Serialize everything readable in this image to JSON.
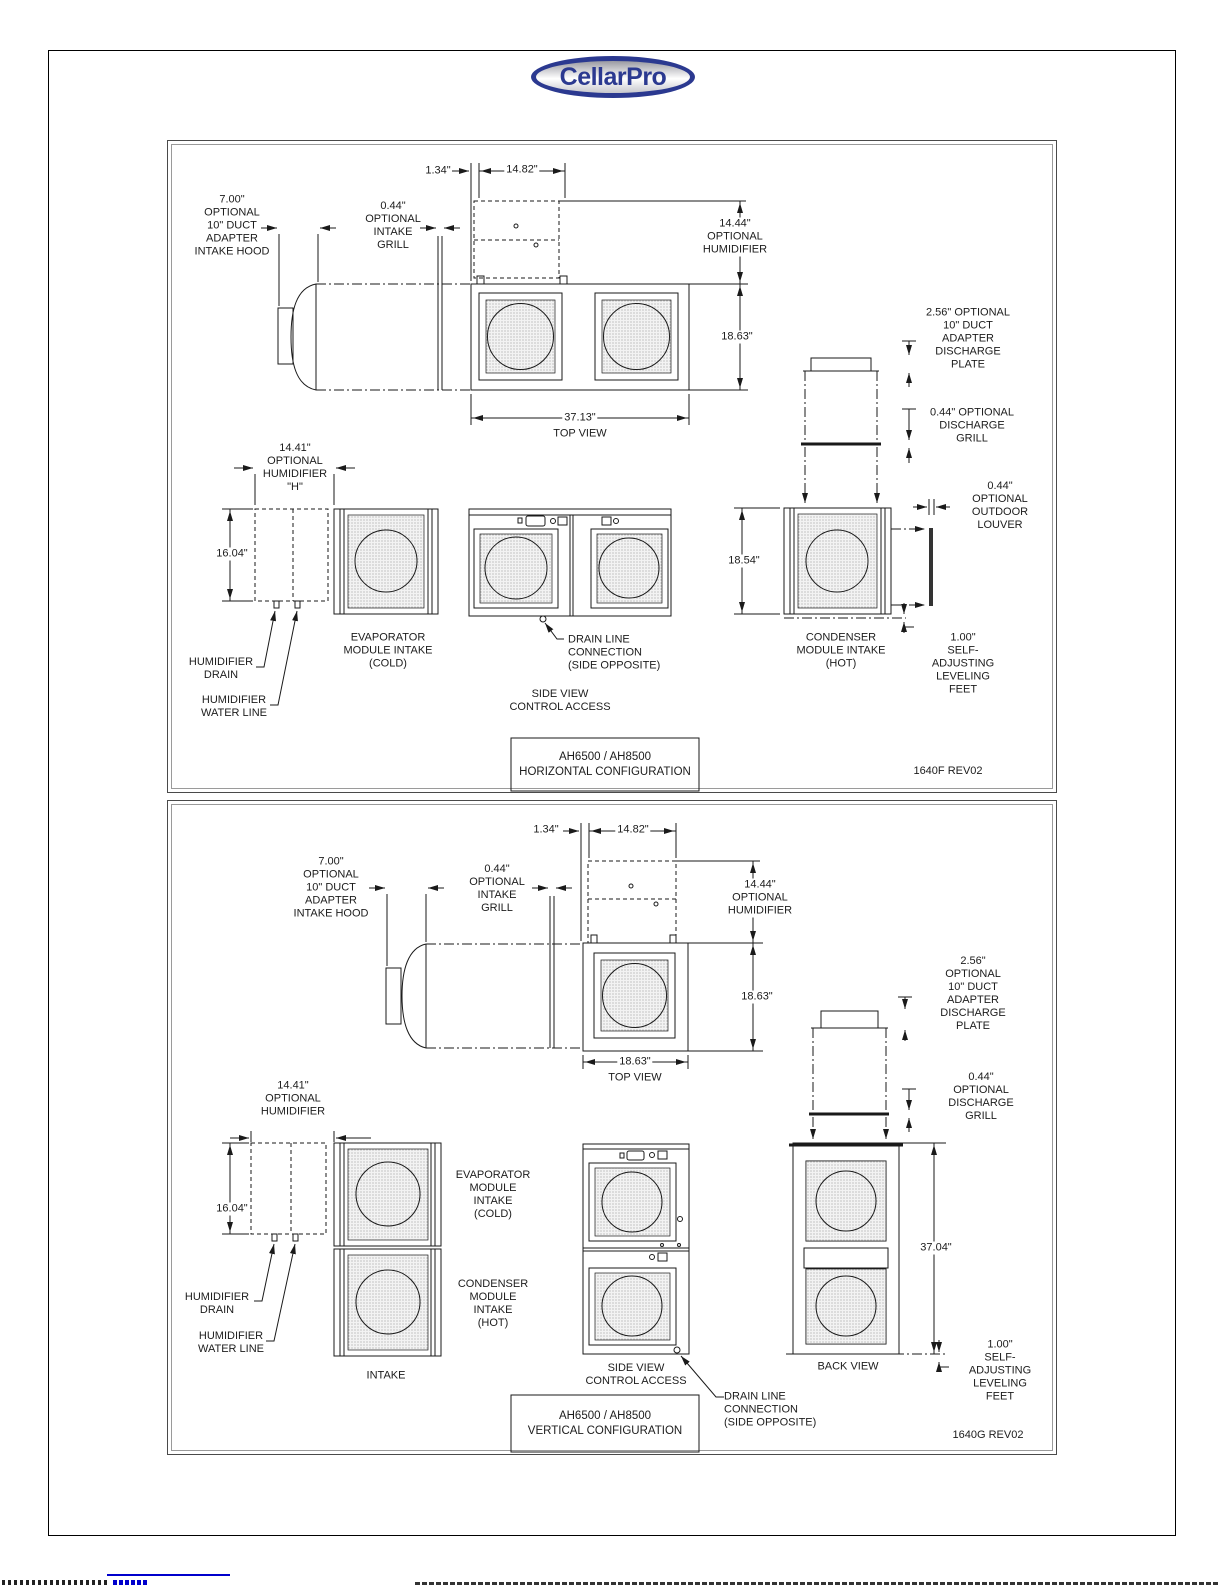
{
  "logo": {
    "text": "CellarPro",
    "ring_color": "#2b3990",
    "text_color": "#2b3990"
  },
  "horizontal": {
    "labels": {
      "dim_gap": "1.34\"",
      "dim_humidifier_width": "14.82\"",
      "intake_hood": "7.00\"\nOPTIONAL\n10\" DUCT\nADAPTER\nINTAKE HOOD",
      "intake_grill": "0.44\"\nOPTIONAL\nINTAKE\nGRILL",
      "humidifier_top": "14.44\"\nOPTIONAL\nHUMIDIFIER",
      "unit_depth": "18.63\"",
      "discharge_plate": "2.56\" OPTIONAL\n10\" DUCT\nADAPTER\nDISCHARGE\nPLATE",
      "unit_width": "37.13\"",
      "top_view": "TOP VIEW",
      "discharge_grill": "0.44\" OPTIONAL\nDISCHARGE\nGRILL",
      "humidifier_side": "14.41\"\nOPTIONAL\nHUMIDIFIER\n\"H\"",
      "humidifier_height": "16.04\"",
      "outdoor_louver": "0.44\" OPTIONAL\nOUTDOOR\nLOUVER",
      "condenser_height": "18.54\"",
      "evaporator_intake": "EVAPORATOR\nMODULE INTAKE\n(COLD)",
      "drain_line": "DRAIN LINE\nCONNECTION\n(SIDE OPPOSITE)",
      "condenser_intake": "CONDENSER\nMODULE INTAKE\n(HOT)",
      "leveling_feet": "1.00\"\nSELF-ADJUSTING\nLEVELING\nFEET",
      "humidifier_drain": "HUMIDIFIER\nDRAIN",
      "humidifier_water": "HUMIDIFIER\nWATER LINE",
      "side_view": "SIDE VIEW\nCONTROL ACCESS"
    },
    "title": "AH6500 / AH8500\nHORIZONTAL CONFIGURATION",
    "doc_number": "1640F REV02"
  },
  "vertical": {
    "labels": {
      "dim_gap": "1.34\"",
      "dim_humidifier_width": "14.82\"",
      "intake_hood": "7.00\"\nOPTIONAL\n10\" DUCT\nADAPTER\nINTAKE HOOD",
      "intake_grill": "0.44\"\nOPTIONAL\nINTAKE\nGRILL",
      "humidifier_top": "14.44\"\nOPTIONAL\nHUMIDIFIER",
      "unit_depth": "18.63\"",
      "discharge_plate": "2.56\" OPTIONAL\n10\" DUCT\nADAPTER\nDISCHARGE\nPLATE",
      "unit_width": "18.63\"",
      "top_view": "TOP VIEW",
      "discharge_grill": "0.44\" OPTIONAL\nDISCHARGE\nGRILL",
      "humidifier_side": "14.41\"\nOPTIONAL\nHUMIDIFIER",
      "humidifier_height": "16.04\"",
      "evaporator_intake": "EVAPORATOR\nMODULE\nINTAKE\n(COLD)",
      "condenser_intake": "CONDENSER\nMODULE\nINTAKE\n(HOT)",
      "intake": "INTAKE",
      "side_view": "SIDE VIEW\nCONTROL ACCESS",
      "back_view": "BACK VIEW",
      "stack_height": "37.04\"",
      "leveling_feet": "1.00\"\nSELF-ADJUSTING\nLEVELING FEET",
      "drain_line": "DRAIN LINE\nCONNECTION\n(SIDE OPPOSITE)",
      "humidifier_drain": "HUMIDIFIER\nDRAIN",
      "humidifier_water": "HUMIDIFIER\nWATER LINE"
    },
    "title": "AH6500 / AH8500\nVERTICAL CONFIGURATION",
    "doc_number": "1640G REV02"
  }
}
